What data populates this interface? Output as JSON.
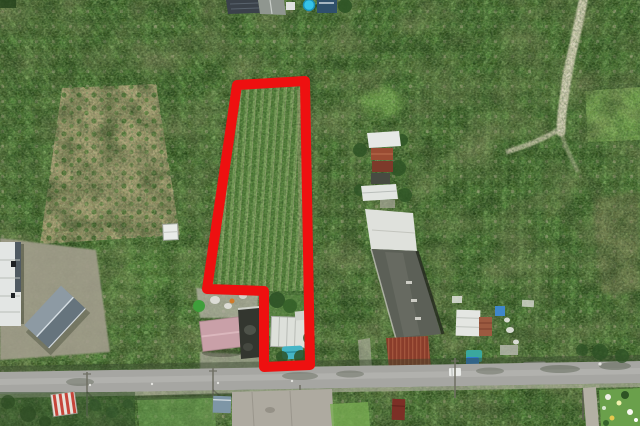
{
  "meta": {
    "type": "aerial-drone-photograph",
    "subject": "Farmland with a red outlined land parcel",
    "setting": "Rural plantation area, farm buildings, rural road across the bottom",
    "image_size": "640x426"
  },
  "parcel": {
    "outline_points": "237,85 305,81 310,365 264,367 264,291 207,289",
    "outline_color": "#ee1010",
    "outline_width": "10",
    "shape": "flag-shaped long narrow plot",
    "upper_area_points": "237,85 305,81 308,291 207,291",
    "lower_area_points": "264,291 308,291 310,365 264,367",
    "contents": "rows of young crop trees; farmyard with white canopy and blue pool at the south end"
  },
  "colors": {
    "vegetation_base": "#4d7838",
    "parcel_rows_green": "#5e8a43",
    "tan_orchard_soil": "#b6a57f",
    "dry_creek": "#d8d1bb",
    "road_asphalt": "#a6a6a2",
    "road_center": "#b6b6b2",
    "concrete_pad": "#aeaaa0",
    "gravel_yard": "#a29d8c",
    "warehouse_gray_roof": "#5c6057",
    "warehouse_white_roof": "#dfe1dc",
    "rust_roof": "#9a4c33",
    "pink_roof": "#c9a0a8",
    "dark_roof": "#33362f",
    "left_barn_roof": "#66747d",
    "white_building": "#e3e6e4",
    "pool_blue": "#45b5c6",
    "truck_blue": "#2f7fd4",
    "teal_tarp": "#3aa89e",
    "cyan_tank": "#35c3e8",
    "blue_shed": "#7e96a6",
    "red_canopy_stripe": "#c6453a",
    "bright_grass": "#79ad52"
  },
  "objects": {
    "top_sheds": "farm sheds with dark panel roof and cyan water tank",
    "left_white_building": "white industrial building at left edge",
    "left_barn": "gray gabled barn in gravel yard",
    "small_white_shed": "small white field shed",
    "farmhouse_cluster": "farmhouse cluster with rust and white roofs",
    "long_warehouse": "long warehouse: white, gray and rust roof sections",
    "sheds_cluster": "open sheds, pallets, tarps and trucks",
    "pink_house": "pink gabled-roof house beside parcel notch",
    "dark_house": "dark concrete house",
    "white_canopy": "white canopy inside parcel",
    "blue_pool": "blue pool tarp inside parcel",
    "road": "rural road with utility poles",
    "dry_creek": "light dry creek path winding from top",
    "flower_garden": "bright garden patch at bottom right"
  }
}
